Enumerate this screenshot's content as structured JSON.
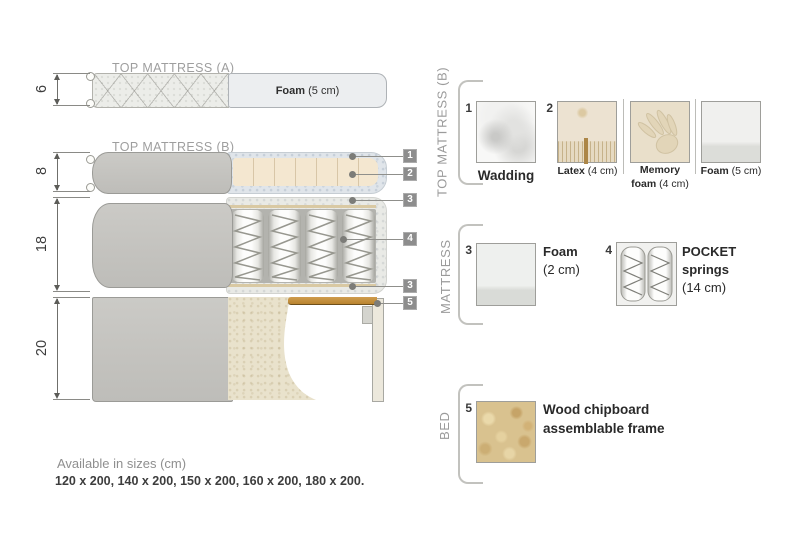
{
  "diagram": {
    "top_a_title": "TOP MATTRESS (A)",
    "top_b_title": "TOP MATTRESS (B)",
    "dims": {
      "top_a": "6",
      "top_b": "8",
      "mattress": "18",
      "bed": "20"
    },
    "foam_a": {
      "bold": "Foam",
      "rest": " (5 cm)"
    },
    "callouts": {
      "c1": "1",
      "c2": "2",
      "c3a": "3",
      "c4": "4",
      "c3b": "3",
      "c5": "5"
    }
  },
  "legend": {
    "sections": {
      "top_b": "TOP MATTRESS (B)",
      "mattress": "MATTRESS",
      "bed": "BED"
    },
    "wadding": {
      "num": "1",
      "label": "Wadding"
    },
    "latex": {
      "num": "2",
      "bold": "Latex",
      "rest": " (4 cm)"
    },
    "memory": {
      "l1": "Memory",
      "l2_bold": "foam",
      "l2_rest": " (4 cm)"
    },
    "foam5": {
      "bold": "Foam",
      "rest": " (5 cm)"
    },
    "foam2": {
      "num": "3",
      "l1": "Foam",
      "l2": "(2 cm)"
    },
    "pocket": {
      "num": "4",
      "l1": "POCKET",
      "l2": "springs",
      "l3": "(14 cm)"
    },
    "chipboard": {
      "num": "5",
      "l1": "Wood chipboard",
      "l2": "assemblable frame"
    }
  },
  "footer": {
    "title": "Available in sizes (cm)",
    "sizes": "120 x 200, 140 x 200, 150 x 200, 160 x 200, 180 x 200."
  },
  "colors": {
    "accent_gray": "#8d8d8d",
    "fabric_gray": "#c7c6c2",
    "foam_cream": "#f3e6cf",
    "wadding_blue": "#dfe4e9",
    "wood": "#c08a3e",
    "chipboard_tan": "#d9c28f"
  }
}
